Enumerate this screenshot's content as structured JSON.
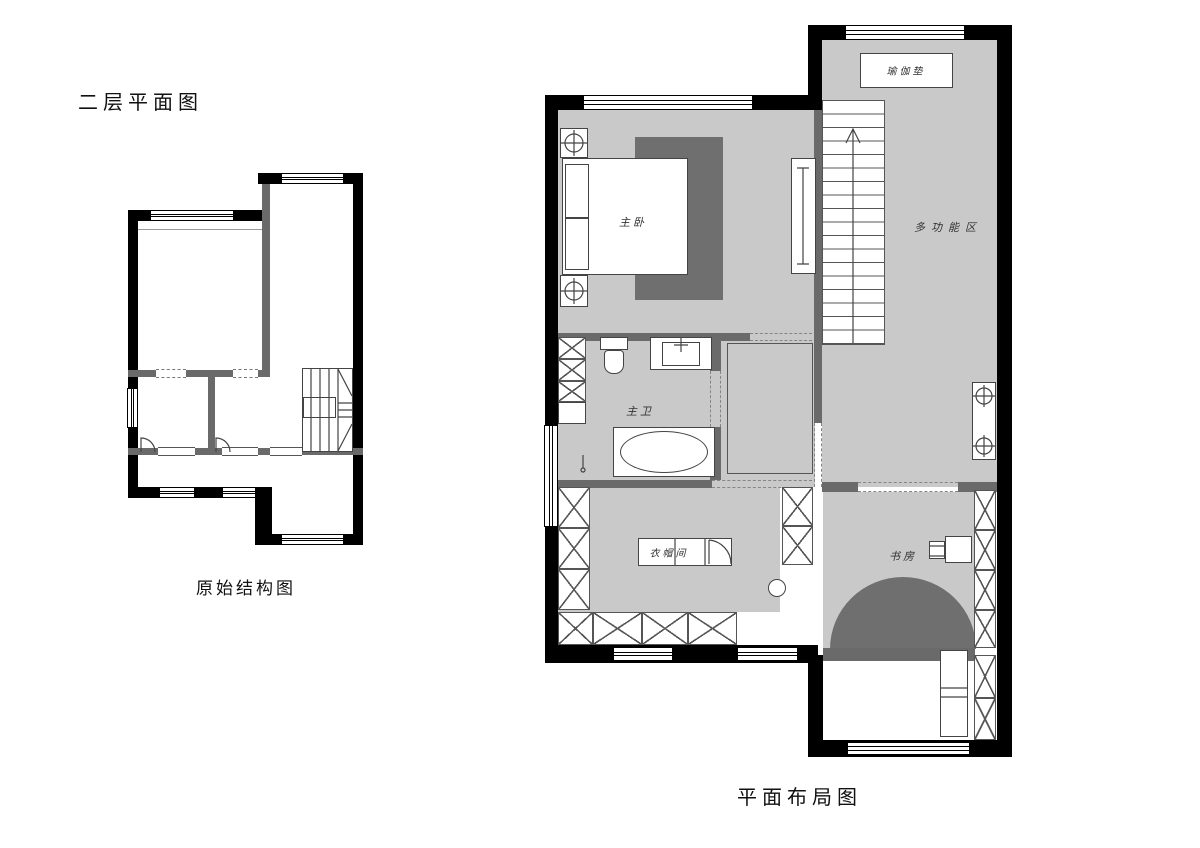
{
  "titles": {
    "second_floor": "二层平面图",
    "original_structure_caption": "原始结构图",
    "layout_plan_caption": "平面布局图"
  },
  "rooms": {
    "yoga_mat": "瑜伽垫",
    "master_bedroom": "主卧",
    "multi_function_area": "多功能区",
    "master_bathroom": "主卫",
    "walk_in_closet": "衣帽间",
    "study": "书房"
  },
  "colors": {
    "exterior_wall": "#000000",
    "interior_wall": "#6a6a6a",
    "floor": "#c9c9c9",
    "rug": "#6f6f6f",
    "background": "#ffffff"
  }
}
